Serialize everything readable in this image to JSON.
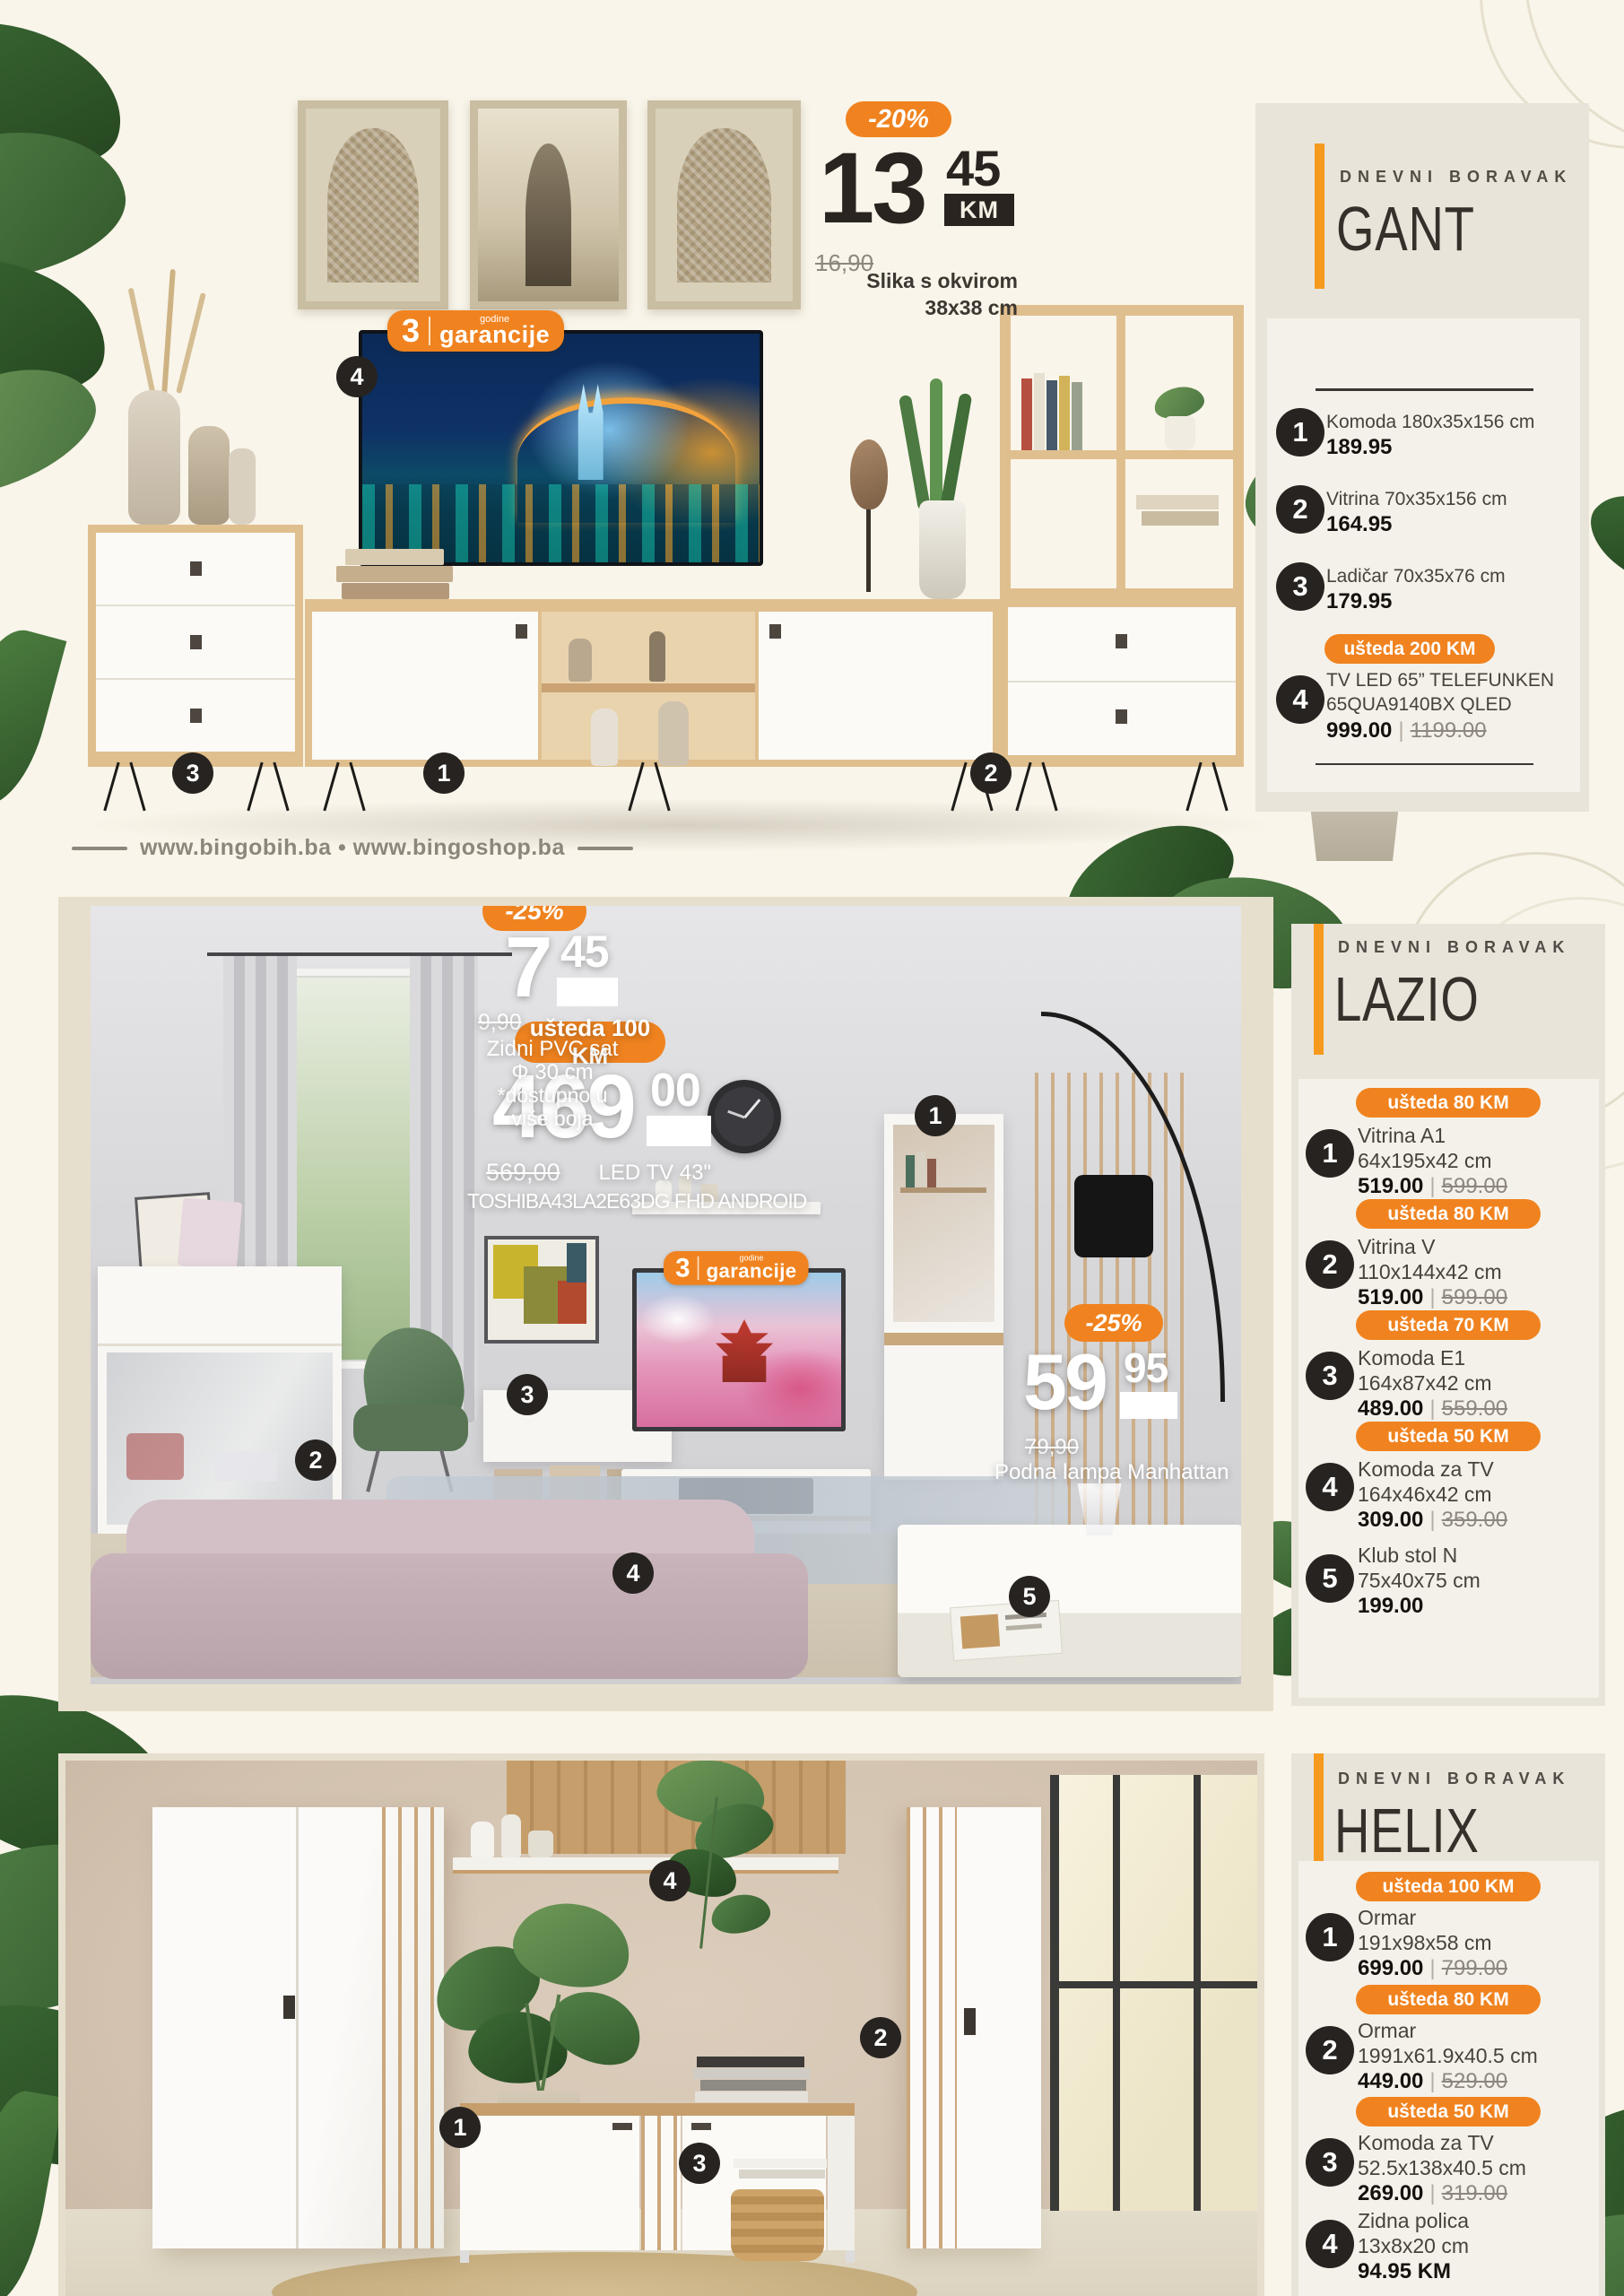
{
  "brand": {
    "urls": "www.bingobih.ba • www.bingoshop.ba"
  },
  "badges": {
    "garancije_count": "3",
    "garancije_top": "godine",
    "garancije_bottom": "garancije"
  },
  "slika": {
    "disc": "-20%",
    "int": "13",
    "dec": "45",
    "km": "KM",
    "old": "16,90",
    "l1": "Slika s okvirom",
    "l2": "38x38 cm"
  },
  "gant": {
    "eyebrow": "DNEVNI BORAVAK",
    "title": "GANT",
    "markers": [
      "1",
      "2",
      "3",
      "4"
    ],
    "items": [
      {
        "num": "1",
        "name": "Komoda 180x35x156 cm",
        "price": "189.95"
      },
      {
        "num": "2",
        "name": "Vitrina 70x35x156 cm",
        "price": "164.95"
      },
      {
        "num": "3",
        "name": "Ladičar 70x35x76 cm",
        "price": "179.95"
      },
      {
        "num": "4",
        "badge": "ušteda 200 KM",
        "name": "TV LED 65” TELEFUNKEN",
        "name2": "65QUA9140BX QLED",
        "price": "999.00",
        "old": "1199.00"
      }
    ]
  },
  "lazio": {
    "eyebrow": "DNEVNI BORAVAK",
    "title": "LAZIO",
    "markers": [
      "1",
      "2",
      "3",
      "4",
      "5"
    ],
    "tv_offer": {
      "badge": "ušteda 100 KM",
      "int": "469",
      "dec": "00",
      "km": "KM",
      "old": "569,00",
      "l1": "LED TV 43\"",
      "l2": "TOSHIBA43LA2E63DG FHD ANDROID"
    },
    "clock_offer": {
      "disc": "-25%",
      "int": "7",
      "dec": "45",
      "km": "KM",
      "old": "9,90",
      "l1": "Zidni PVC sat",
      "l2": "Φ 30 cm",
      "l3": "*dostupno u",
      "l4": "više boja"
    },
    "lamp_offer": {
      "disc": "-25%",
      "int": "59",
      "dec": "95",
      "km": "KM",
      "old": "79,90",
      "l1": "Podna lampa Manhattan"
    },
    "items": [
      {
        "num": "1",
        "badge": "ušteda 80 KM",
        "name": "Vitrina A1",
        "dims": "64x195x42 cm",
        "price": "519.00",
        "old": "599.00"
      },
      {
        "num": "2",
        "badge": "ušteda 80 KM",
        "name": "Vitrina V",
        "dims": "110x144x42 cm",
        "price": "519.00",
        "old": "599.00"
      },
      {
        "num": "3",
        "badge": "ušteda 70 KM",
        "name": "Komoda E1",
        "dims": "164x87x42 cm",
        "price": "489.00",
        "old": "559.00"
      },
      {
        "num": "4",
        "badge": "ušteda 50 KM",
        "name": "Komoda za TV",
        "dims": "164x46x42 cm",
        "price": "309.00",
        "old": "359.00"
      },
      {
        "num": "5",
        "name": "Klub stol N",
        "dims": "75x40x75 cm",
        "price": "199.00"
      }
    ]
  },
  "helix": {
    "eyebrow": "DNEVNI BORAVAK",
    "title": "HELIX",
    "markers": [
      "1",
      "2",
      "3",
      "4"
    ],
    "items": [
      {
        "num": "1",
        "badge": "ušteda 100 KM",
        "name": "Ormar",
        "dims": "191x98x58 cm",
        "price": "699.00",
        "old": "799.00"
      },
      {
        "num": "2",
        "badge": "ušteda 80 KM",
        "name": "Ormar",
        "dims": "1991x61.9x40.5 cm",
        "price": "449.00",
        "old": "529.00"
      },
      {
        "num": "3",
        "badge": "ušteda 50 KM",
        "name": "Komoda za TV",
        "dims": "52.5x138x40.5 cm",
        "price": "269.00",
        "old": "319.00"
      },
      {
        "num": "4",
        "name": "Zidna polica",
        "dims": "13x8x20 cm",
        "price": "94.95 KM"
      }
    ]
  }
}
